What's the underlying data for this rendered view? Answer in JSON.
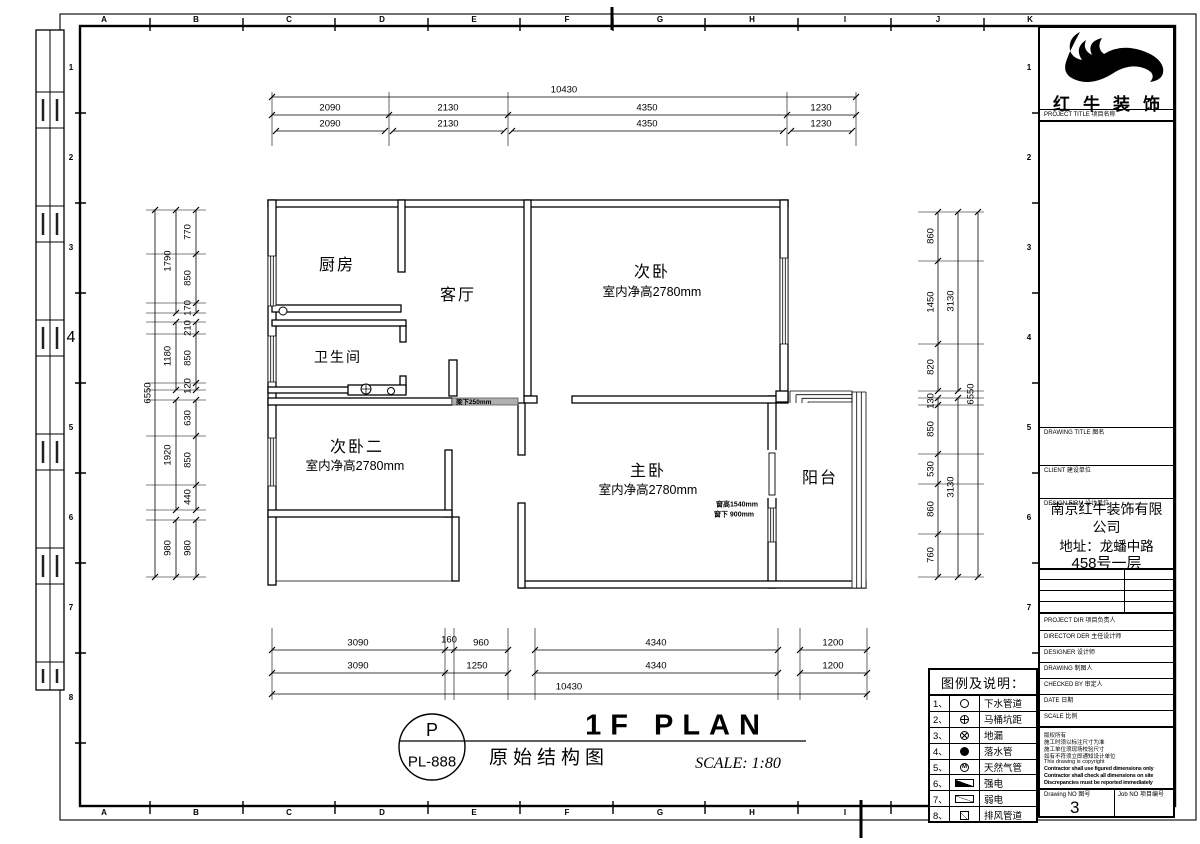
{
  "frame": {
    "grid_letters": [
      "A",
      "B",
      "C",
      "D",
      "E",
      "F",
      "G",
      "H",
      "I",
      "J",
      "K"
    ],
    "grid_numbers": [
      "1",
      "2",
      "3",
      "4",
      "5",
      "6",
      "7",
      "8"
    ]
  },
  "plan": {
    "rooms": {
      "kitchen": "厨房",
      "living": "客厅",
      "bath": "卫生间",
      "bed2": "次卧",
      "bed2_note": "室内净高2780mm",
      "bed3": "次卧二",
      "bed3_note": "室内净高2780mm",
      "master": "主卧",
      "master_note": "室内净高2780mm",
      "balcony": "阳台"
    },
    "annotations": {
      "beam": "梁下250mm",
      "window_height": "窗高1540mm",
      "window_sill": "窗下 900mm"
    }
  },
  "dimensions": {
    "top": {
      "total": "10430",
      "row1": [
        "2090",
        "2130",
        "4350",
        "1230"
      ],
      "row2": [
        "2090",
        "2130",
        "4350",
        "1230"
      ]
    },
    "bottom": {
      "row1": [
        "3090",
        "160",
        "960",
        "4340",
        "1200"
      ],
      "row2": [
        "3090",
        "1250",
        "4340",
        "1200"
      ],
      "total": "10430"
    },
    "left": {
      "total": "6550",
      "mid": [
        "1790",
        "1180",
        "1920",
        "980"
      ],
      "inner": [
        "770",
        "850",
        "170",
        "210",
        "850",
        "120",
        "630",
        "850",
        "440",
        "980"
      ]
    },
    "right": {
      "total": "6550",
      "mid": [
        "3130",
        "3130"
      ],
      "inner": [
        "860",
        "1450",
        "820",
        "130",
        "850",
        "530",
        "860",
        "760"
      ]
    }
  },
  "titlebar": {
    "badge_top": "P",
    "badge_bottom": "PL-888",
    "title": "1F PLAN",
    "subtitle": "原始结构图",
    "scale": "SCALE: 1:80"
  },
  "legend": {
    "title": "图例及说明：",
    "items": [
      {
        "no": "1、",
        "icon": "drain-pipe-circle",
        "label": "下水管道"
      },
      {
        "no": "2、",
        "icon": "toilet-pit-circle-cross",
        "label": "马桶坑距"
      },
      {
        "no": "3、",
        "icon": "floor-drain-circle-x",
        "label": "地漏"
      },
      {
        "no": "4、",
        "icon": "downpipe-filled-circle",
        "label": "落水管"
      },
      {
        "no": "5、",
        "icon": "gas-pipe-circle-m",
        "icon_char": "M",
        "label": "天然气管"
      },
      {
        "no": "6、",
        "icon": "strong-power-triangle",
        "label": "强电"
      },
      {
        "no": "7、",
        "icon": "weak-power-triangle",
        "label": "弱电"
      },
      {
        "no": "8、",
        "icon": "vent-duct-square",
        "label": "排风管道"
      }
    ]
  },
  "titleblock": {
    "brand": "红牛装饰",
    "project_label": "PROJECT TITLE 项目名称",
    "drawing_title_label": "DRAWING TITLE 图名",
    "client_label": "CLIENT 建设单位",
    "design_firm_label": "DESIGN FIRM 设计单位",
    "company_lines": [
      "南京红牛装饰有限",
      "公司",
      "地址：龙蟠中路",
      "458号一层"
    ],
    "project_dir_label": "PROJECT DIR 项目负责人",
    "director_label": "DIRECTOR DER 主任设计师",
    "designer_label": "DESIGNER 设计师",
    "drawing_label": "DRAWING 制图人",
    "checked_label": "CHECKED BY 审定人",
    "date_label": "DATE 日期",
    "scale_label": "SCALE 比例",
    "notes": [
      "版权所有",
      "施工时须以标注尺寸为准",
      "施工单位须现场校验尺寸",
      "如有不符须立即通知设计单位",
      "This drawing is copyright",
      "Contractor shall use figured dimensions only",
      "Contractor shall check all dimensions on site",
      "Discrepancies must be reported immediately"
    ],
    "drawing_no_label": "Drawing NO 图号",
    "drawing_no_value": "3",
    "job_no_label": "Job NO 项目编号"
  }
}
